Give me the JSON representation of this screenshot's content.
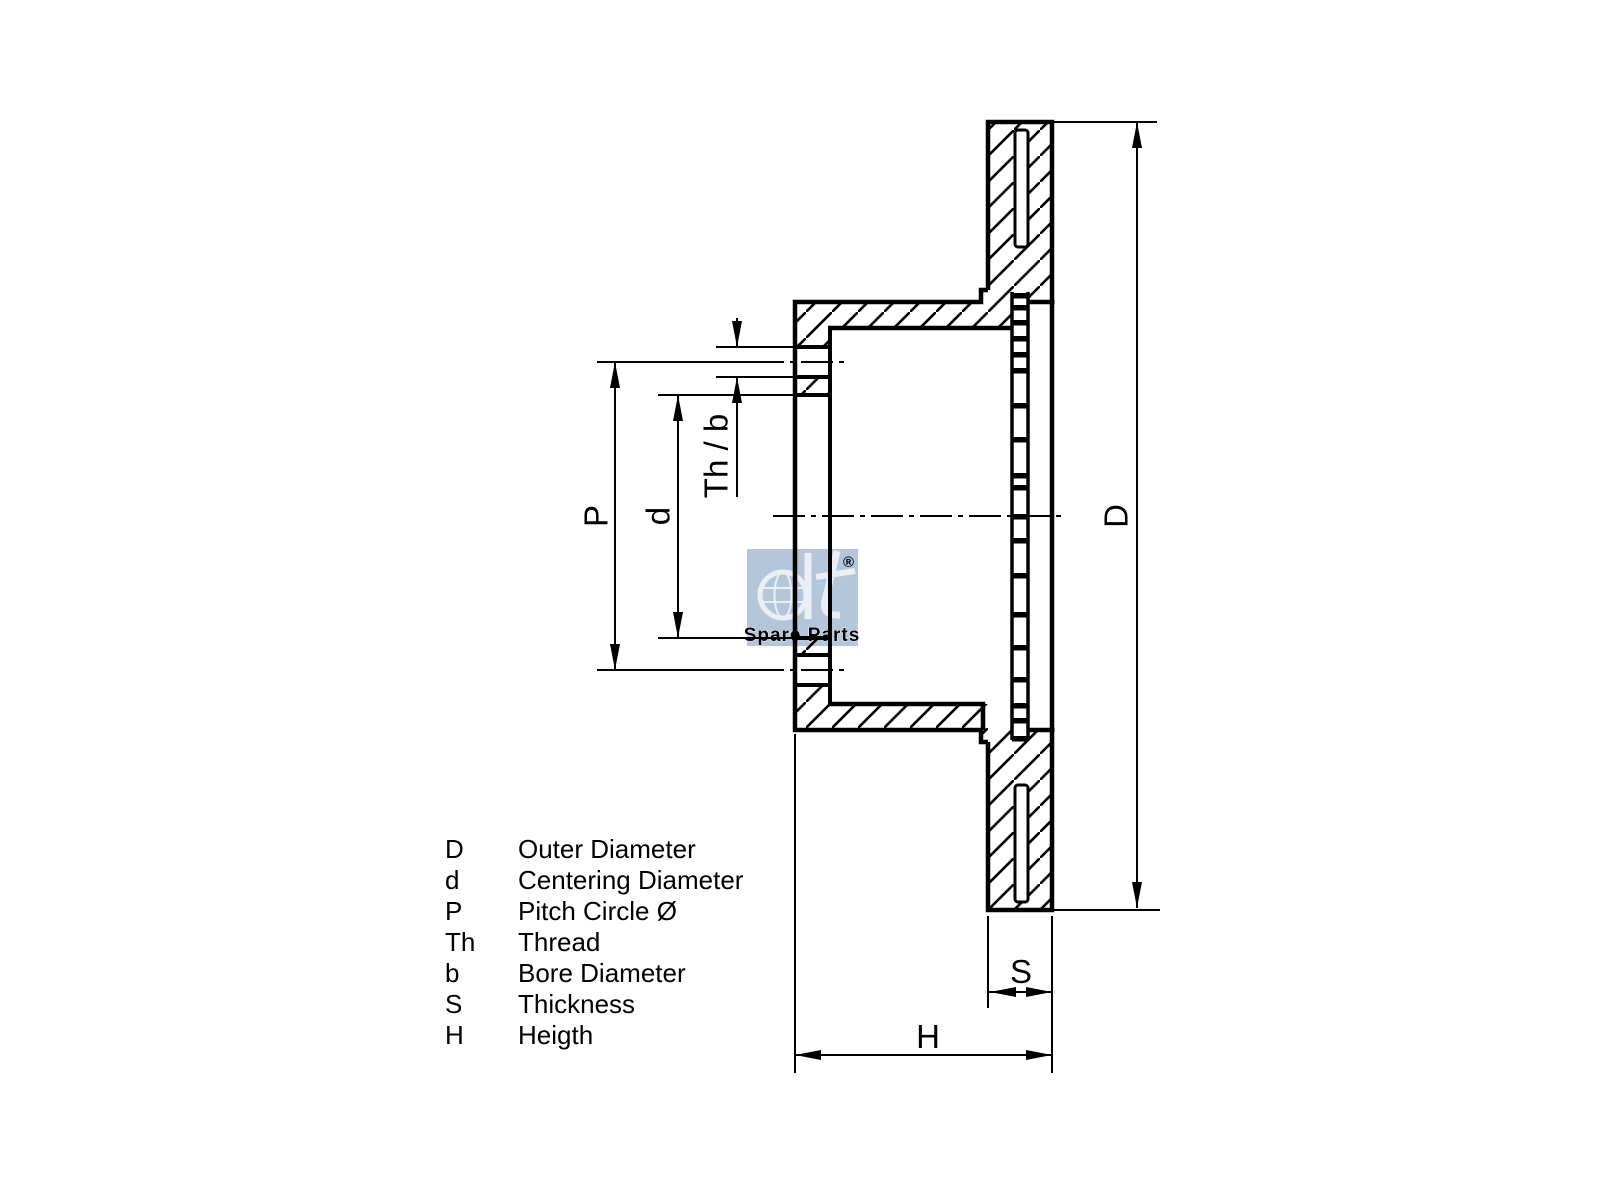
{
  "watermark": {
    "bg_color": "#b4c7da",
    "logo_text": "dt",
    "registered_mark": "®",
    "subtitle": "Spare Parts"
  },
  "dimension_labels": {
    "pitch_circle": "P",
    "centering_diameter": "d",
    "thread_bore": "Th / b",
    "outer_diameter": "D",
    "thickness": "S",
    "height": "H"
  },
  "legend": {
    "rows": [
      {
        "symbol": "D",
        "description": "Outer Diameter"
      },
      {
        "symbol": "d",
        "description": "Centering Diameter"
      },
      {
        "symbol": "P",
        "description": "Pitch Circle Ø"
      },
      {
        "symbol": "Th",
        "description": "Thread"
      },
      {
        "symbol": "b",
        "description": "Bore Diameter"
      },
      {
        "symbol": "S",
        "description": "Thickness"
      },
      {
        "symbol": "H",
        "description": "Heigth"
      }
    ]
  }
}
